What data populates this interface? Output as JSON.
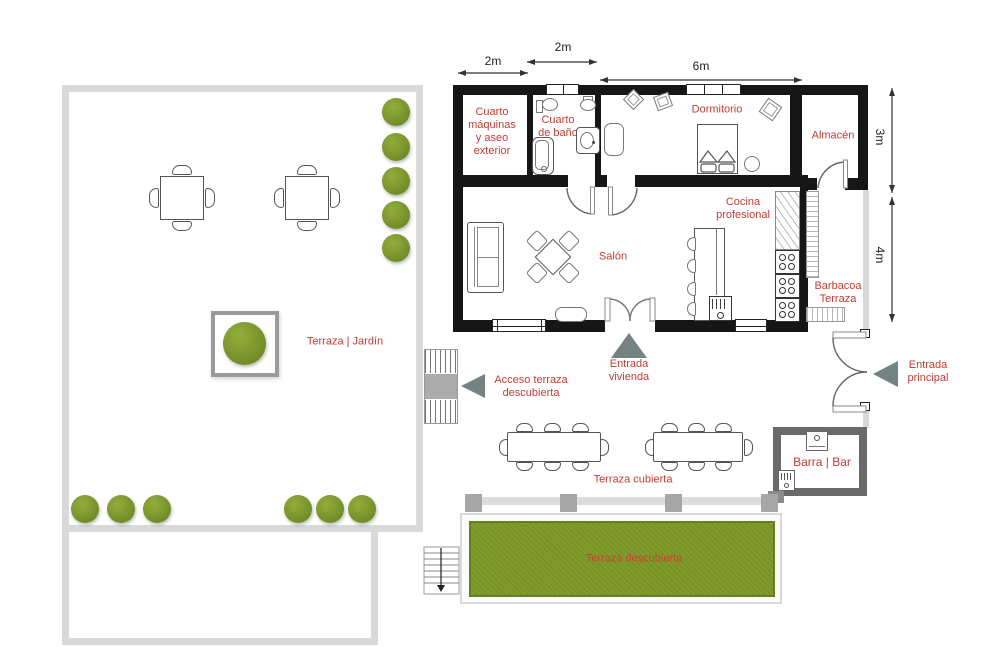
{
  "labels": {
    "machine_room": "Cuarto\nmáquinas\ny aseo\nexterior",
    "bathroom": "Cuarto\nde baño",
    "bedroom": "Dormitorio",
    "storage": "Almacén",
    "living": "Salón",
    "kitchen": "Cocina\nprofesional",
    "bbq": "Barbacoa\nTerraza",
    "garden": "Terraza | Jardín",
    "access_terrace": "Acceso terraza\ndescubierta",
    "home_entrance": "Entrada\nvivienda",
    "main_entrance": "Entrada\nprincipal",
    "covered_terrace": "Terraza cubierta",
    "bar": "Barra | Bar",
    "open_terrace": "Terraza descubierta"
  },
  "dims": {
    "top": [
      "2m",
      "2m",
      "6m"
    ],
    "right": [
      "3m",
      "4m"
    ]
  },
  "colors": {
    "label_red": "#c63b30",
    "wall_black": "#161616",
    "wall_light_gray": "#d9d9d9",
    "bar_wall_gray": "#6a6a6a",
    "pillar_gray": "#a6a6a6",
    "bush_green": "#76912a",
    "grass_green": "#7c9827",
    "entrance_triangle_gray": "#748282"
  }
}
